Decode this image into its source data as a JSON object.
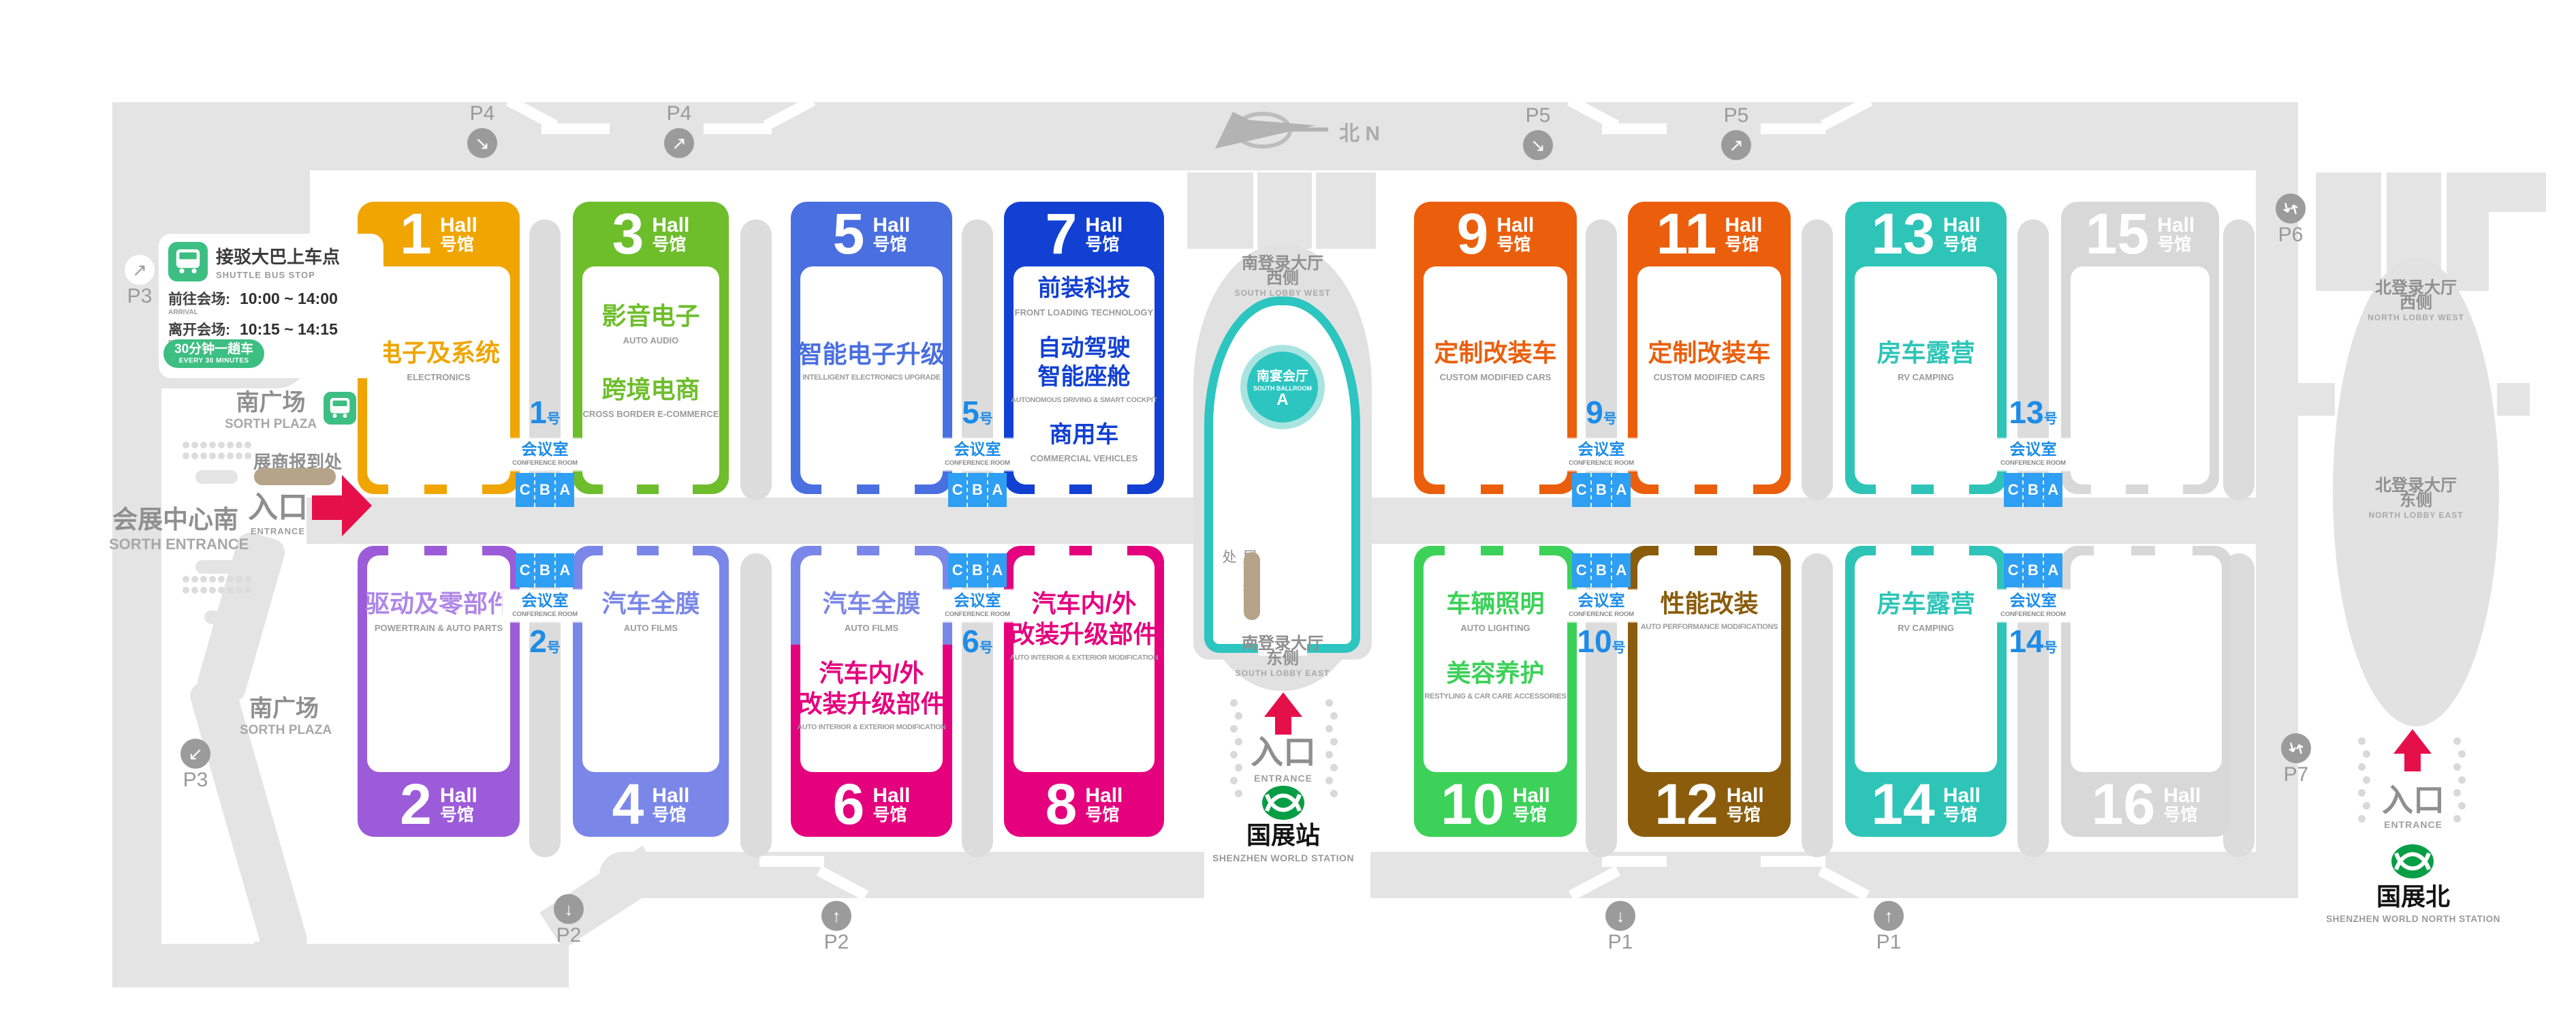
{
  "colors": {
    "hall1": "#F0A500",
    "hall2": "#9C5BD8",
    "hall2_text": "#AE87E8",
    "hall3": "#6EBE2C",
    "hall4": "#7B87E8",
    "hall5": "#4A6FE0",
    "hall6_top": "#7B87E8",
    "hall6_bottom": "#E5007D",
    "hall7": "#1240D2",
    "hall8": "#E5007D",
    "hall9": "#EB5F0C",
    "hall10": "#3CD159",
    "hall11": "#EB5F0C",
    "hall12": "#8A5C0C",
    "hall13": "#2EC5B8",
    "hall14": "#2EC5B8",
    "hall15": "#D8D8D8",
    "hall16": "#D8D8D8",
    "conference_blue": "#2F9FF3",
    "accent_red": "#E5104A",
    "metro_green": "#089E45",
    "shuttle_green": "#3DBE82",
    "ballroom_teal": "#2CC5C0",
    "checkin_tan": "#B5A489",
    "road_gray": "#E4E4E4"
  },
  "compass": {
    "cn": "北",
    "en": "N"
  },
  "hall_suffix": {
    "en": "Hall",
    "cn": "号馆"
  },
  "halls": [
    {
      "num": "1",
      "cats": [
        {
          "cn": "电子及系统",
          "en": "ELECTRONICS"
        }
      ]
    },
    {
      "num": "2",
      "cats": [
        {
          "cn": "驱动及零部件",
          "en": "POWERTRAIN & AUTO PARTS"
        }
      ]
    },
    {
      "num": "3",
      "cats": [
        {
          "cn": "影音电子",
          "en": "AUTO AUDIO"
        },
        {
          "cn": "跨境电商",
          "en": "CROSS BORDER E-COMMERCE"
        }
      ]
    },
    {
      "num": "4",
      "cats": [
        {
          "cn": "汽车全膜",
          "en": "AUTO FILMS"
        }
      ]
    },
    {
      "num": "5",
      "cats": [
        {
          "cn": "智能电子升级",
          "en": "INTELLIGENT ELECTRONICS UPGRADE"
        }
      ]
    },
    {
      "num": "6",
      "cats": [
        {
          "cn": "汽车全膜",
          "en": "AUTO FILMS"
        },
        {
          "cn": "汽车内/外",
          "cn2": "改装升级部件",
          "en": "AUTO INTERIOR & EXTERIOR MODIFICATION"
        }
      ]
    },
    {
      "num": "7",
      "cats": [
        {
          "cn": "前装科技",
          "en": "FRONT LOADING TECHNOLOGY"
        },
        {
          "cn": "自动驾驶",
          "cn2": "智能座舱",
          "en": "AUTONOMOUS DRIVING & SMART COCKPIT"
        },
        {
          "cn": "商用车",
          "en": "COMMERCIAL VEHICLES"
        }
      ]
    },
    {
      "num": "8",
      "cats": [
        {
          "cn": "汽车内/外",
          "cn2": "改装升级部件",
          "en": "AUTO INTERIOR & EXTERIOR MODIFICATION"
        }
      ]
    },
    {
      "num": "9",
      "cats": [
        {
          "cn": "定制改装车",
          "en": "CUSTOM MODIFIED CARS"
        }
      ]
    },
    {
      "num": "10",
      "cats": [
        {
          "cn": "车辆照明",
          "en": "AUTO LIGHTING"
        },
        {
          "cn": "美容养护",
          "en": "RESTYLING & CAR CARE ACCESSORIES"
        }
      ]
    },
    {
      "num": "11",
      "cats": [
        {
          "cn": "定制改装车",
          "en": "CUSTOM MODIFIED CARS"
        }
      ]
    },
    {
      "num": "12",
      "cats": [
        {
          "cn": "性能改装",
          "en": "AUTO PERFORMANCE MODIFICATIONS"
        }
      ]
    },
    {
      "num": "13",
      "cats": [
        {
          "cn": "房车露营",
          "en": "RV CAMPING"
        }
      ]
    },
    {
      "num": "14",
      "cats": [
        {
          "cn": "房车露营",
          "en": "RV CAMPING"
        }
      ]
    },
    {
      "num": "15",
      "cats": []
    },
    {
      "num": "16",
      "cats": []
    }
  ],
  "conference": {
    "label": "会议室",
    "label_en": "CONFERENCE ROOM",
    "suffix": "号",
    "c": "C",
    "b": "B",
    "a": "A",
    "rooms": {
      "r1": "1",
      "r5": "5",
      "r9": "9",
      "r13": "13",
      "r2": "2",
      "r6": "6",
      "r10": "10",
      "r14": "14"
    }
  },
  "shuttle": {
    "title": "接驳大巴上车点",
    "title_en": "SHUTTLE BUS STOP",
    "arrive_label": "前往会场:",
    "arrive_en": "ARRIVAL",
    "arrive_time": "10:00 ~ 14:00",
    "depart_label": "离开会场:",
    "depart_en": "DEPARTURE",
    "depart_time": "10:15 ~ 14:15",
    "freq": "30分钟一趟车",
    "freq_en": "EVERY 30 MINUTES"
  },
  "labels": {
    "south_entrance_cn": "会展中心南",
    "south_entrance_en": "SORTH ENTRANCE",
    "entrance_cn": "入口",
    "entrance_en": "ENTRANCE",
    "checkin": "展商报到处",
    "plaza_cn": "南广场",
    "plaza_en": "SORTH PLAZA",
    "lobby_sw_cn1": "南登录大厅",
    "lobby_sw_cn2": "西侧",
    "lobby_sw_en": "SOUTH LOBBY WEST",
    "lobby_se_cn1": "南登录大厅",
    "lobby_se_cn2": "东侧",
    "lobby_se_en": "SOUTH LOBBY EAST",
    "lobby_nw_cn1": "北登录大厅",
    "lobby_nw_cn2": "西侧",
    "lobby_nw_en": "NORTH LOBBY WEST",
    "lobby_ne_cn1": "北登录大厅",
    "lobby_ne_cn2": "东侧",
    "lobby_ne_en": "NORTH LOBBY EAST",
    "ballroom_cn": "南宴会厅",
    "ballroom_en": "SOUTH BALLROOM",
    "ballroom_hall": "A",
    "station_south_cn": "国展站",
    "station_south_en": "SHENZHEN WORLD STATION",
    "station_north_cn": "国展北",
    "station_north_en": "SHENZHEN WORLD NORTH STATION"
  },
  "parking": {
    "p3_west": "P3",
    "p3_south": "P3",
    "p4_a": "P4",
    "p4_b": "P4",
    "p5_a": "P5",
    "p5_b": "P5",
    "p2_a": "P2",
    "p2_b": "P2",
    "p1_a": "P1",
    "p1_b": "P1",
    "p6": "P6",
    "p7": "P7"
  }
}
